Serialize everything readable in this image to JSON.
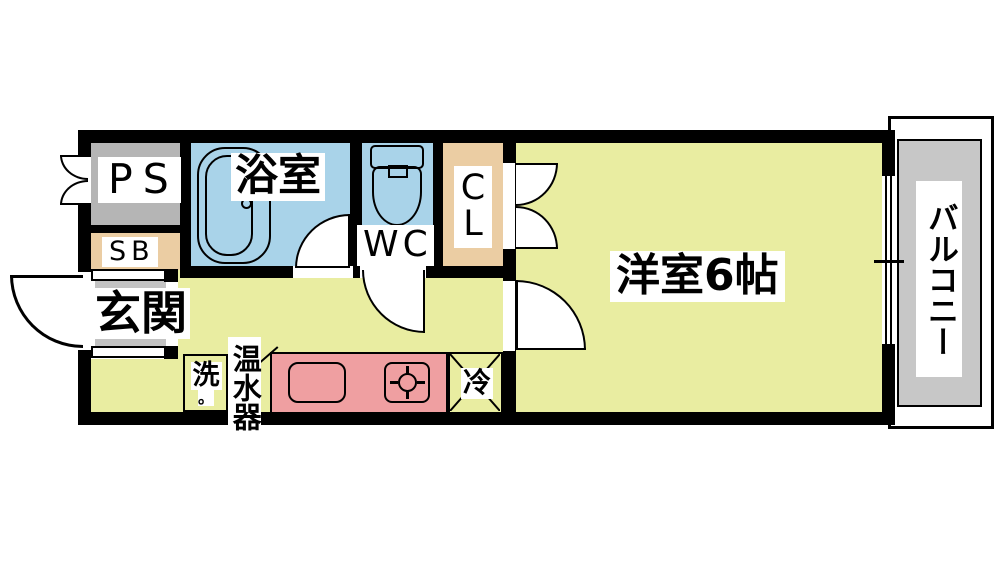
{
  "plan": {
    "type": "floor-plan",
    "rooms": {
      "ps": "PS",
      "sb": "SB",
      "bath": "浴室",
      "wc": "WC",
      "closet_chars": [
        "C",
        "L"
      ],
      "entrance": "玄関",
      "western_room": "洋室6帖",
      "balcony": "バルコニー"
    },
    "fixtures": {
      "washer": "洗",
      "washer_mark": "。",
      "water_heater": "温水器",
      "refrigerator": "冷"
    },
    "colors": {
      "wall": "#000000",
      "floor": "#e9eda1",
      "wet_area_blue": "#a9d3e9",
      "storage_tan": "#ebcda3",
      "kitchen_pink": "#ef9fa1",
      "pipe_space_gray": "#b5b5b5",
      "step_gray": "#c3c3c3",
      "balcony_gray": "#c7c7c7"
    }
  }
}
